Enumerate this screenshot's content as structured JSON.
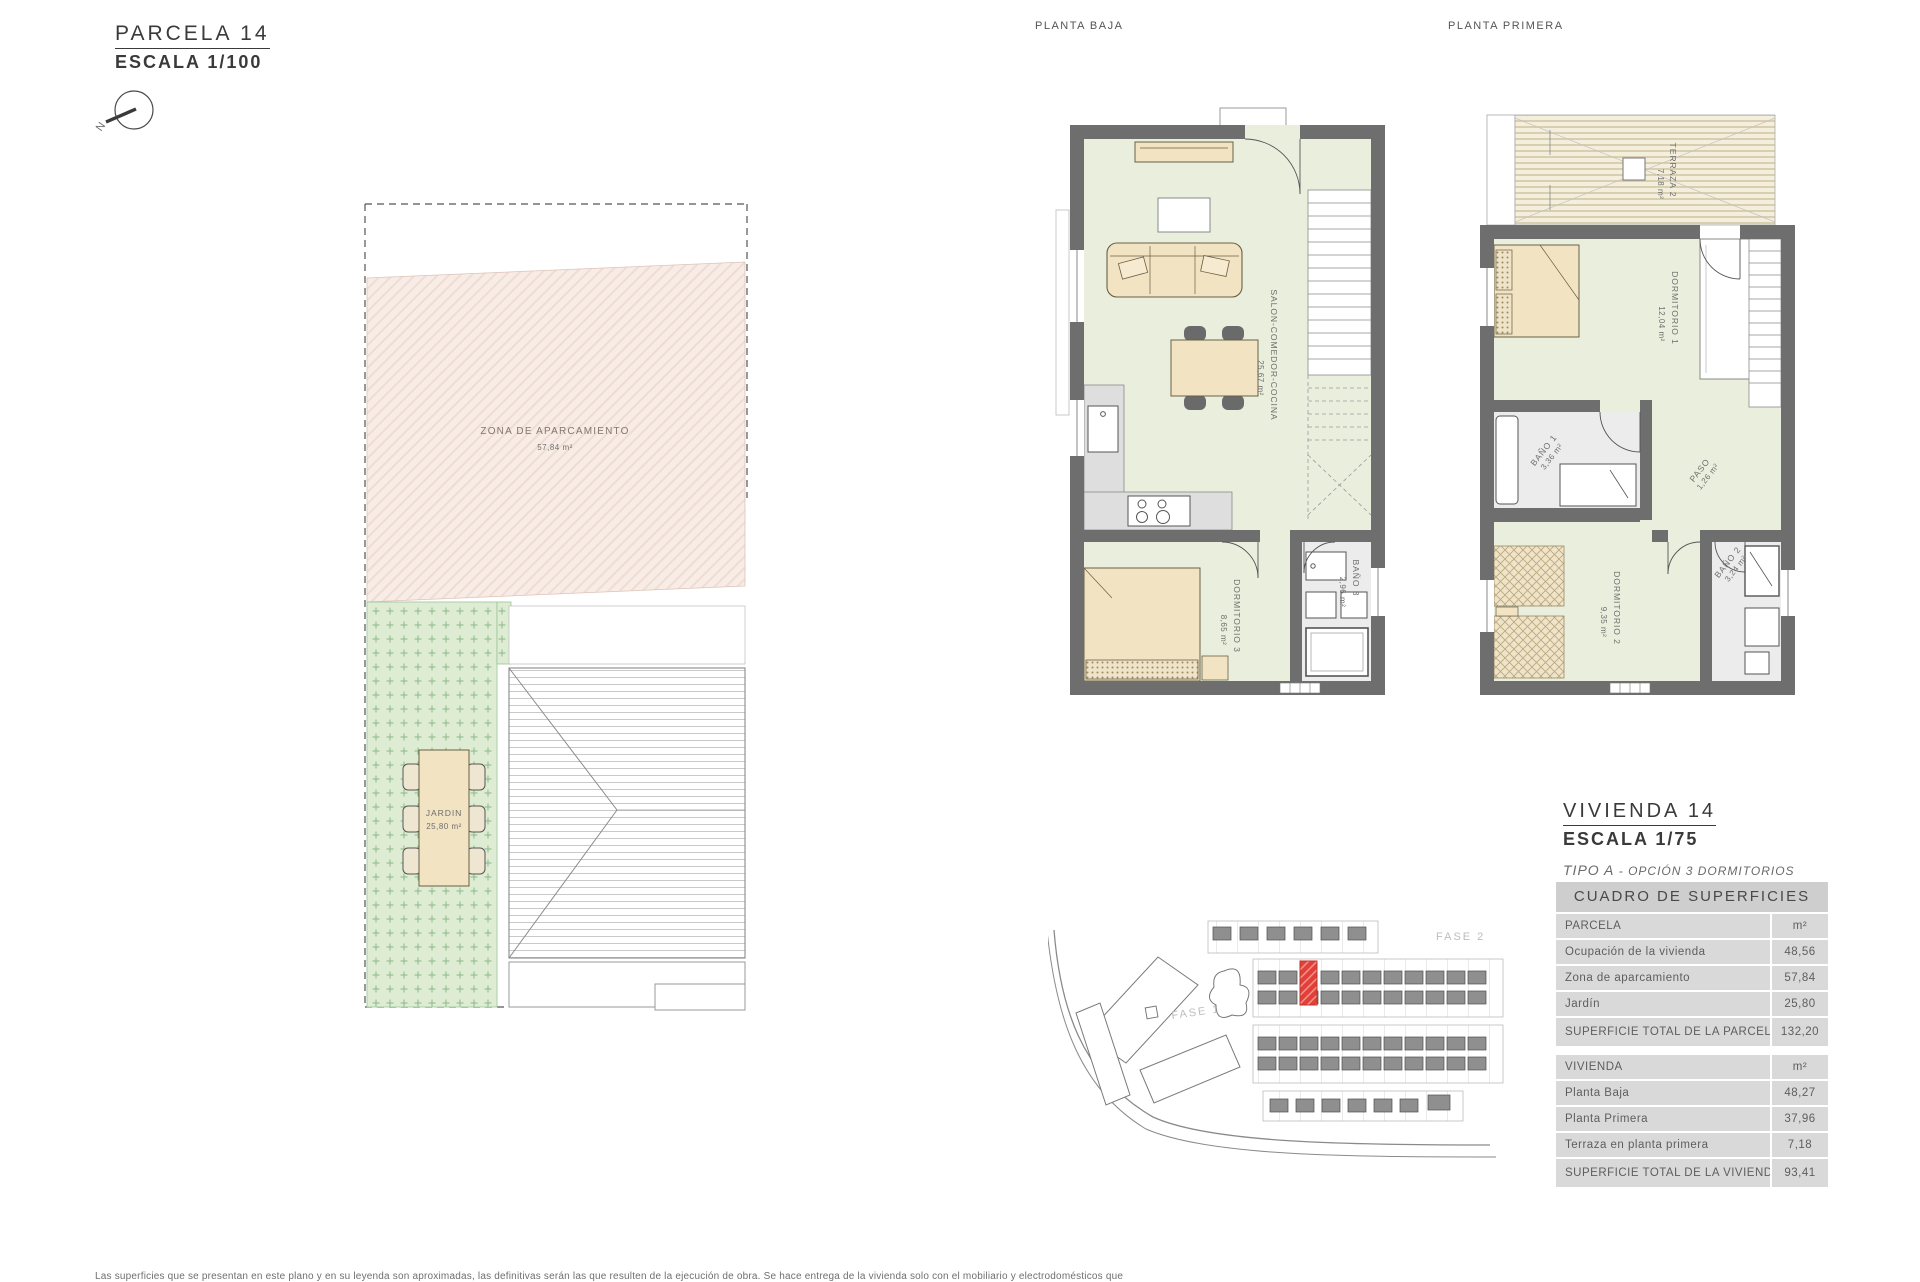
{
  "parcela_block": {
    "title": "PARCELA 14",
    "scale": "ESCALA 1/100"
  },
  "north": {
    "label": "N"
  },
  "parcel_plan": {
    "parking": {
      "name": "ZONA DE APARCAMIENTO",
      "area": "57,84 m²"
    },
    "garden": {
      "name": "JARDIN",
      "area": "25,80 m²"
    }
  },
  "ground_floor": {
    "title": "PLANTA BAJA",
    "salon": {
      "name": "SALON-COMEDOR-COCINA",
      "area": "25,67 m²"
    },
    "dorm3": {
      "name": "DORMITORIO 3",
      "area": "8,65 m²"
    },
    "bano3": {
      "name": "BAÑO 3",
      "area": "2,96 m²"
    }
  },
  "first_floor": {
    "title": "PLANTA PRIMERA",
    "terraza": {
      "name": "TERRAZA 2",
      "area": "7,18 m²"
    },
    "dorm1": {
      "name": "DORMITORIO 1",
      "area": "12,04 m²"
    },
    "bano1": {
      "name": "BAÑO 1",
      "area": "3,36 m²"
    },
    "paso": {
      "name": "PASO",
      "area": "1,26 m²"
    },
    "dorm2": {
      "name": "DORMITORIO 2",
      "area": "9,35 m²"
    },
    "bano2": {
      "name": "BAÑO 2",
      "area": "3,24 m²"
    }
  },
  "site_plan": {
    "fase1": "FASE 1",
    "fase2": "FASE 2",
    "highlight_color": "#e04038"
  },
  "vivienda_block": {
    "title": "VIVIENDA 14",
    "scale": "ESCALA 1/75",
    "tipo": "TIPO A",
    "opcion": "- OPCIÓN 3 DORMITORIOS"
  },
  "surface_table": {
    "title": "CUADRO DE SUPERFICIES",
    "parcela_rows": [
      {
        "label": "PARCELA",
        "value": "m²"
      },
      {
        "label": "Ocupación de la vivienda",
        "value": "48,56"
      },
      {
        "label": "Zona de aparcamiento",
        "value": "57,84"
      },
      {
        "label": "Jardín",
        "value": "25,80"
      },
      {
        "label": "SUPERFICIE TOTAL DE LA PARCELA",
        "value": "132,20"
      }
    ],
    "vivienda_rows": [
      {
        "label": "VIVIENDA",
        "value": "m²"
      },
      {
        "label": "Planta Baja",
        "value": "48,27"
      },
      {
        "label": "Planta Primera",
        "value": "37,96"
      },
      {
        "label": "Terraza en planta primera",
        "value": "7,18"
      },
      {
        "label": "SUPERFICIE TOTAL DE LA VIVIENDA",
        "value": "93,41"
      }
    ]
  },
  "footer": {
    "disclaimer": "Las superficies que se presentan en este plano y en su leyenda son aproximadas, las definitivas serán las que resulten de la ejecución de obra. Se hace entrega de la vivienda solo con el mobiliario y electrodomésticos que"
  }
}
